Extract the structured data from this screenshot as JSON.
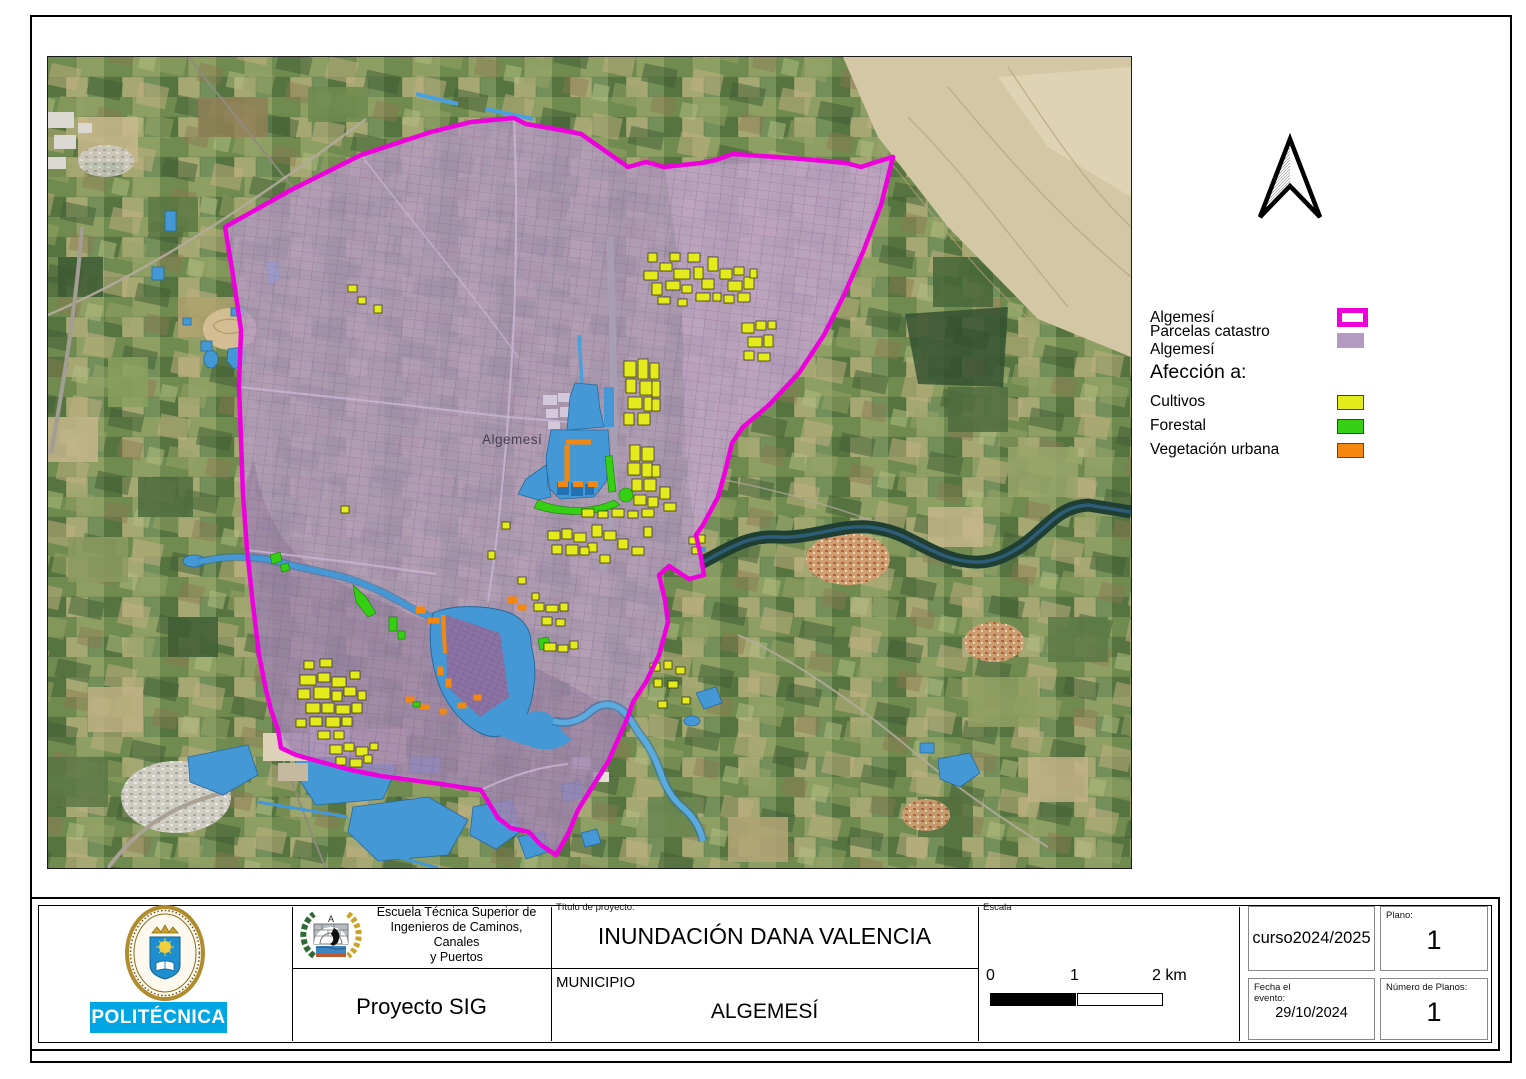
{
  "map": {
    "town_label": "Algemesí"
  },
  "legend": {
    "items": [
      {
        "label": "Algemesí"
      },
      {
        "label": "Parcelas catastro Algemesí"
      }
    ],
    "section_title": "Afección a:",
    "affection": [
      {
        "label": "Cultivos"
      },
      {
        "label": "Forestal"
      },
      {
        "label": "Vegetación urbana"
      }
    ]
  },
  "colors": {
    "boundary_magenta": "#ee00dd",
    "parcels_purple": "#b49ac2",
    "cultivos_yellow": "#e4eb1c",
    "forestal_green": "#35d014",
    "vegetacion_orange": "#f5860e",
    "water_blue": "#4498d6",
    "upm_blue": "#00a5e4"
  },
  "title_block": {
    "politecnica_label": "POLITÉCNICA",
    "school_name": "Escuela Técnica Superior de\nIngenieros de Caminos, Canales\ny Puertos",
    "project_name": "Proyecto SIG",
    "project_title_label": "Título de proyecto:",
    "project_title": "INUNDACIÓN DANA VALENCIA",
    "municipality_label": "MUNICIPIO",
    "municipality_value": "ALGEMESÍ",
    "scale_label": "Escala",
    "scale_tick_0": "0",
    "scale_tick_1": "1",
    "scale_tick_2": "2 km",
    "course_value": "curso2024/2025",
    "plan_label": "Plano:",
    "plan_value": "1",
    "event_date_label": "Fecha el evento:",
    "event_date_value": "29/10/2024",
    "plans_count_label": "Número de Planos:",
    "plans_count_value": "1"
  }
}
